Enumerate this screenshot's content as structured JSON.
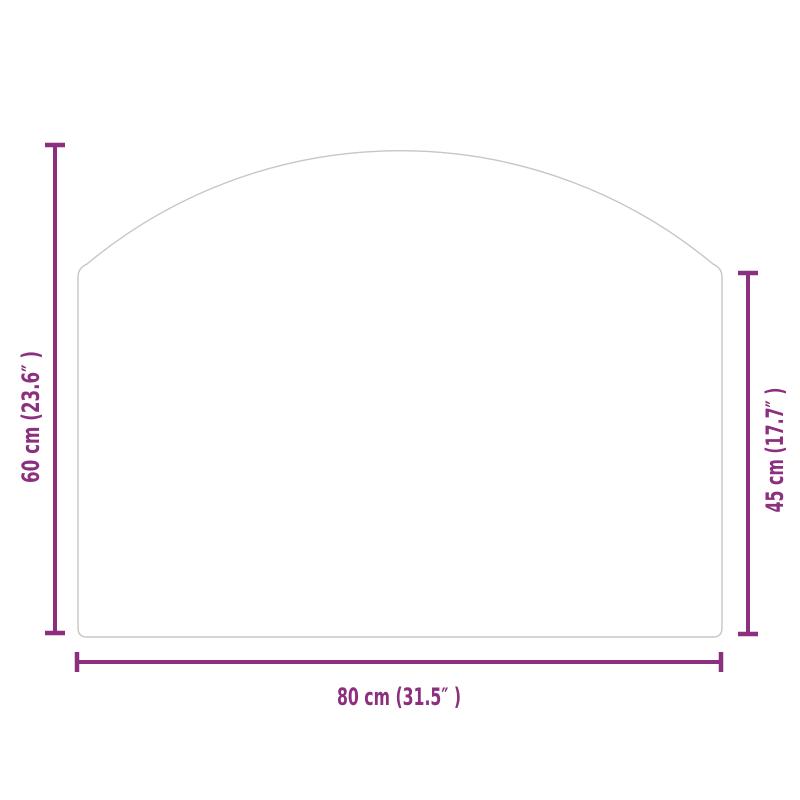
{
  "colors": {
    "dimension": "#8B2F7E",
    "plate_outline": "#C6C6C6",
    "background": "#FFFFFF"
  },
  "dimensions": {
    "height": {
      "label": "60 cm (23.6″ )"
    },
    "side_height": {
      "label": "45 cm (17.7″ )"
    },
    "width": {
      "label": "80 cm (31.5″ )"
    }
  }
}
